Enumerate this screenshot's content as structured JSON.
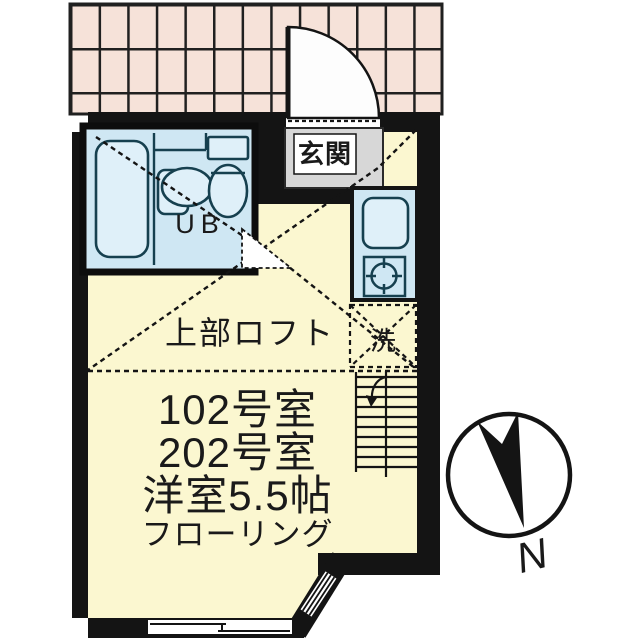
{
  "floorplan": {
    "entrance_label": "玄関",
    "unit_bath_label": "UB",
    "loft_label": "上部ロフト",
    "laundry_label": "洗",
    "room_info_lines": [
      "102号室",
      "202号室",
      "洋室5.5帖",
      "フローリング"
    ],
    "compass_label": "N"
  },
  "colors": {
    "wall": "#141414",
    "room_fill": "#fbf7d0",
    "wet_area_fill": "#cfe7f3",
    "fixture_fill": "#dff0f9",
    "tile_fill": "#f6e2d9",
    "entrance_fill": "#d7d7d7"
  }
}
